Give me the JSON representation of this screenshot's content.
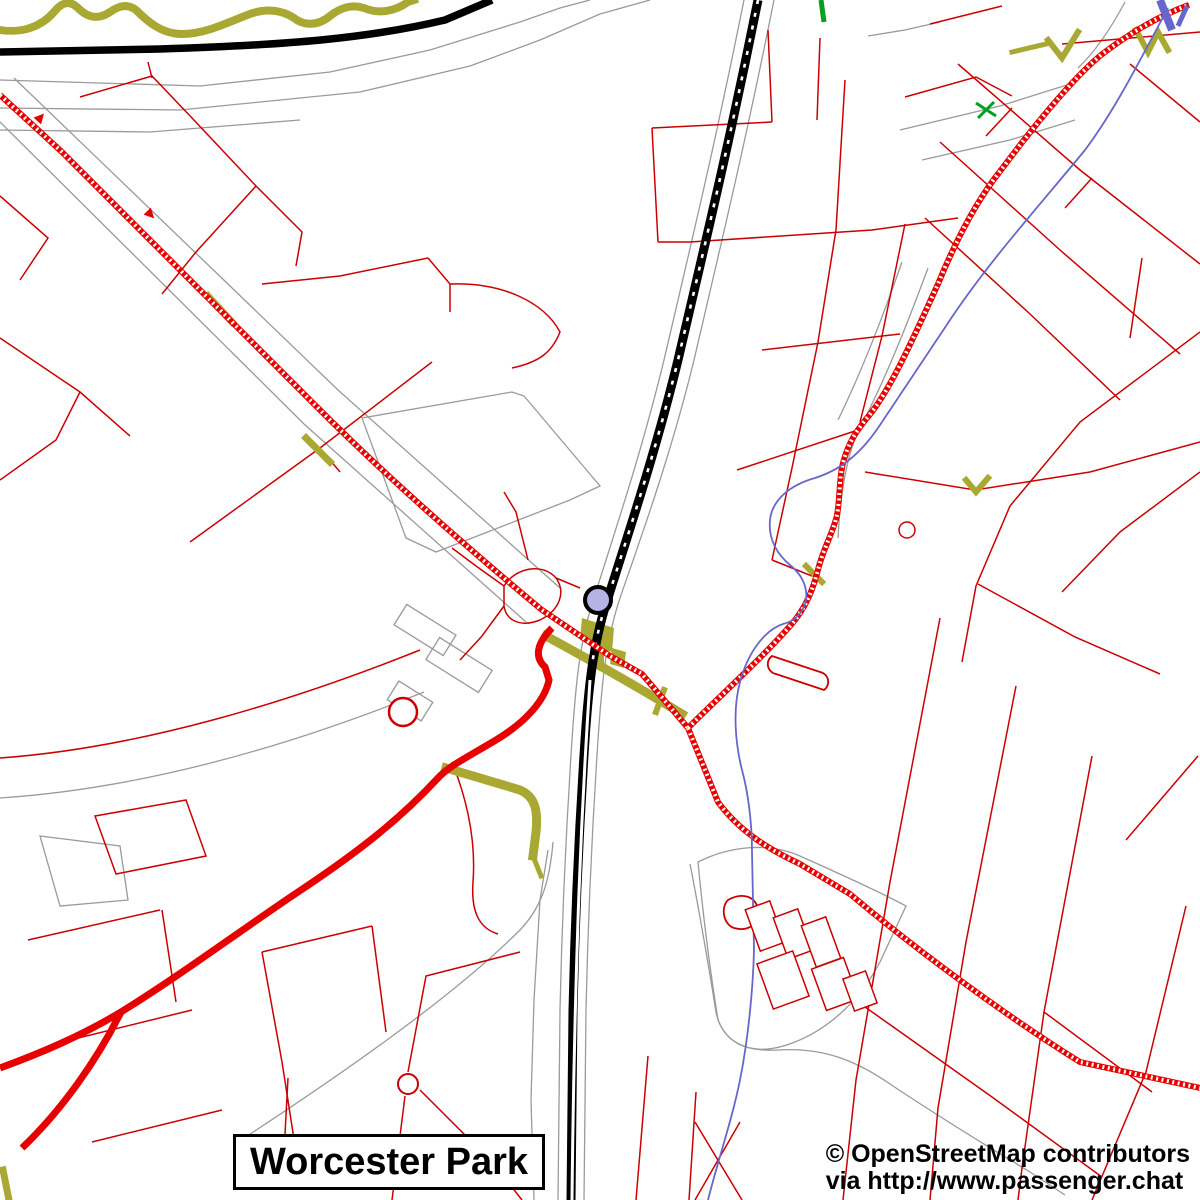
{
  "map": {
    "place_label": "Worcester Park",
    "attribution": {
      "line1": "© OpenStreetMap contributors",
      "line2": "via http://www.passenger.chat"
    },
    "markers": {
      "station": "railway-station"
    },
    "legend_colors": {
      "background": "#ffffff",
      "minor_road": "#cc0000",
      "primary_road": "#e80000",
      "trunk_road": "#000000",
      "railway": "#000000",
      "footpath": "#a8a832",
      "stream": "#6666cc",
      "greenway": "#00a020",
      "outline": "#9a9a9a",
      "station_fill": "#b3b3e6",
      "label_color": "#000000",
      "label_box_bg": "#ffffff",
      "label_box_border": "#000000"
    }
  }
}
